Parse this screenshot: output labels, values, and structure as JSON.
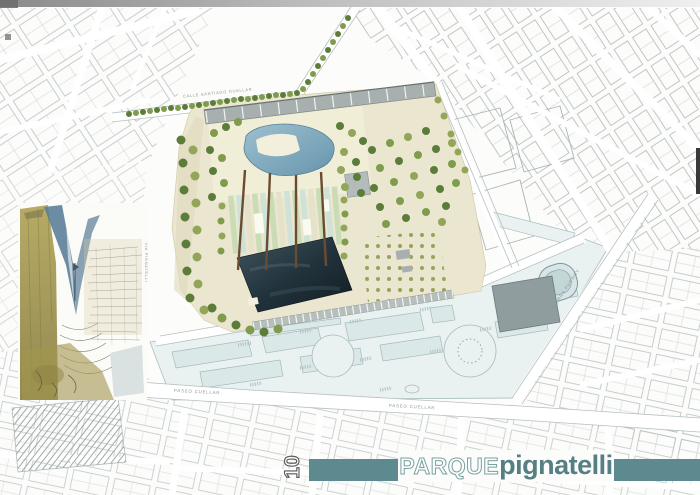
{
  "titleblock": {
    "sheet_number": "10",
    "title_outline": "PARQUE",
    "title_solid": "pignatelli"
  },
  "street_labels": {
    "paseo_cuellar_west": "PASEO CUELLAR",
    "paseo_cuellar_east": "PASEO CUELLAR",
    "calle_santiago_guallar": "CALLE SANTIAGO GUALLAR",
    "lasierra_purroy": "LASIERRA PURROY",
    "via_pignatelli": "VIA PIGNATELLI"
  },
  "colors": {
    "title_bar_teal": "#5d8a8e",
    "park_base_cream": "#ebe6cf",
    "reflecting_pool_dark": "#162128",
    "lagoon_blue": "#7fa6ba",
    "city_block_blue": "#dbe8e8",
    "map_line_gray": "#b4bdbf",
    "tree_green": "#6d8a42",
    "pergola_brown": "#6b4c31"
  }
}
